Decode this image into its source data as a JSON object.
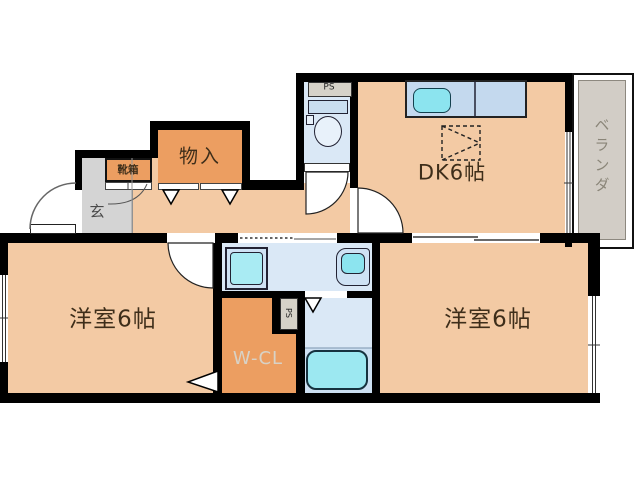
{
  "plan": {
    "rooms": {
      "dk": {
        "label": "DK6帖"
      },
      "bedroom_left": {
        "label": "洋室6帖"
      },
      "bedroom_right": {
        "label": "洋室6帖"
      },
      "storage": {
        "label": "物入"
      },
      "shoe_box": {
        "label": "靴箱"
      },
      "entrance": {
        "label": "玄"
      },
      "walk_in_closet": {
        "label": "W-CL"
      },
      "veranda": {
        "label": "ベランダ"
      },
      "pipe_space_top": {
        "label": "PS"
      },
      "pipe_space_mid": {
        "label": "PS"
      }
    },
    "fixtures": {
      "kitchen_counter": "kitchen-counter-with-sink",
      "refrigerator_space": "refrigerator-space-dashed",
      "toilet": "toilet-with-tank",
      "washbasin": "washbasin",
      "washing_machine": "washing-machine-pan",
      "bathtub": "bathtub"
    }
  },
  "colors": {
    "wall": "#000000",
    "floor": "#f3caa4",
    "closet": "#ec9e61",
    "wet_area": "#dae8f6",
    "wet_area_deep": "#cde0f2",
    "fixture_cyan": "#8ce4ef",
    "counter_blue": "#c4d9ee",
    "entry_gray": "#d4d4d4",
    "veranda_gray": "#d2cdc6",
    "ps_gray": "#d6d2c8",
    "label_dark": "#3e2e1a",
    "wcl_label": "#d8d2c6",
    "veranda_label": "#8a8578"
  }
}
